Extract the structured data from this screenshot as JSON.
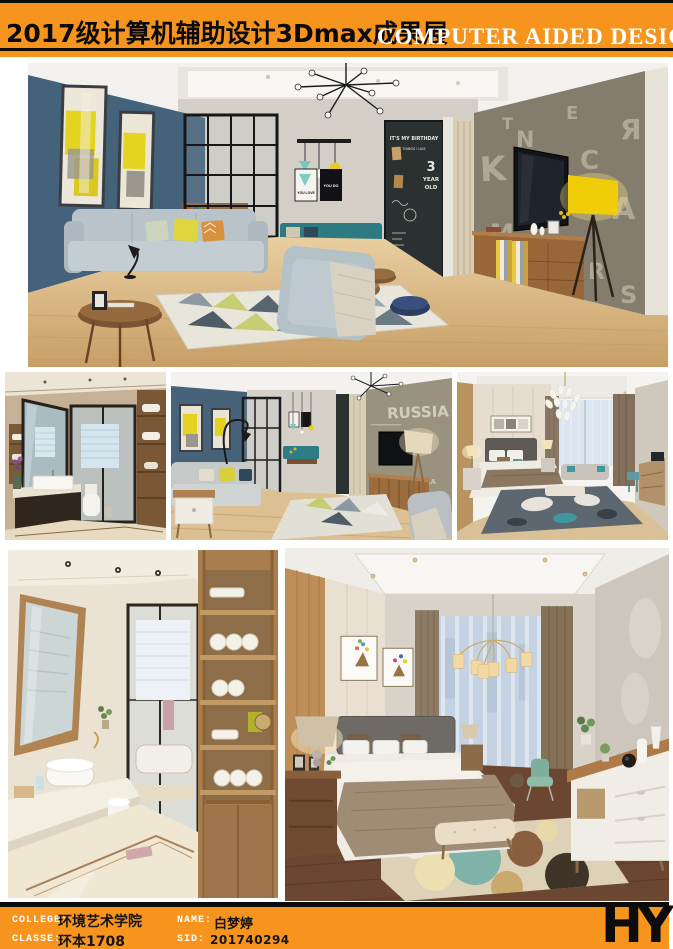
{
  "page": {
    "background": "#ffffff",
    "accent_orange": "#f7941e",
    "line_black": "#0a0a0a"
  },
  "header": {
    "title_cn": "2017级计算机辅助设计3Dmax成果展",
    "title_en": "COMPUTER AIDED DESIGN"
  },
  "footer": {
    "college_label": "COLLEGE:",
    "college_value": "环境艺术学院",
    "classe_label": "CLASSE:",
    "classe_value": "环本1708",
    "name_label": "NAME:",
    "name_value": "白梦婷",
    "sid_label": "SID:",
    "sid_value": "201740294",
    "logo": "HY"
  },
  "gallery": {
    "main": {
      "description": "Living room rendering with blue accent wall, yellow abstract paintings, glass partition, chalkboard wall, TV wall with letter-pattern wallpaper and yellow floor lamp",
      "poster_left": "YOU LOVE",
      "poster_right": "YOU DO",
      "chalk_line1": "IT'S MY BIRTHDAY",
      "chalk_line2": "THINGS I LIKE",
      "chalk_num": "3",
      "chalk_year": "YEAR",
      "chalk_old": "OLD",
      "letters": [
        "K",
        "N",
        "O",
        "C",
        "A",
        "M",
        "H",
        "R",
        "Я",
        "T",
        "E",
        "S"
      ]
    },
    "bath1": {
      "description": "Bathroom rendering with wood cabinetry, tilted vanity mirror and black-framed glass shower door"
    },
    "living2": {
      "description": "Living room rendering toward TV wall with word-art wallpaper and tripod floor lamp",
      "wall_word": "RUSSIA"
    },
    "bed1": {
      "description": "Bedroom rendering with petal chandelier, upholstered bed, window seat and teal-accent rug"
    },
    "bath2": {
      "description": "Bathroom rendering with open wooden towel shelving, round vessel sink and glass partition"
    },
    "bed2": {
      "description": "Bedroom rendering with cylinder-shade chandelier, deer artwork, white sideboard and circle-pattern rug"
    }
  }
}
